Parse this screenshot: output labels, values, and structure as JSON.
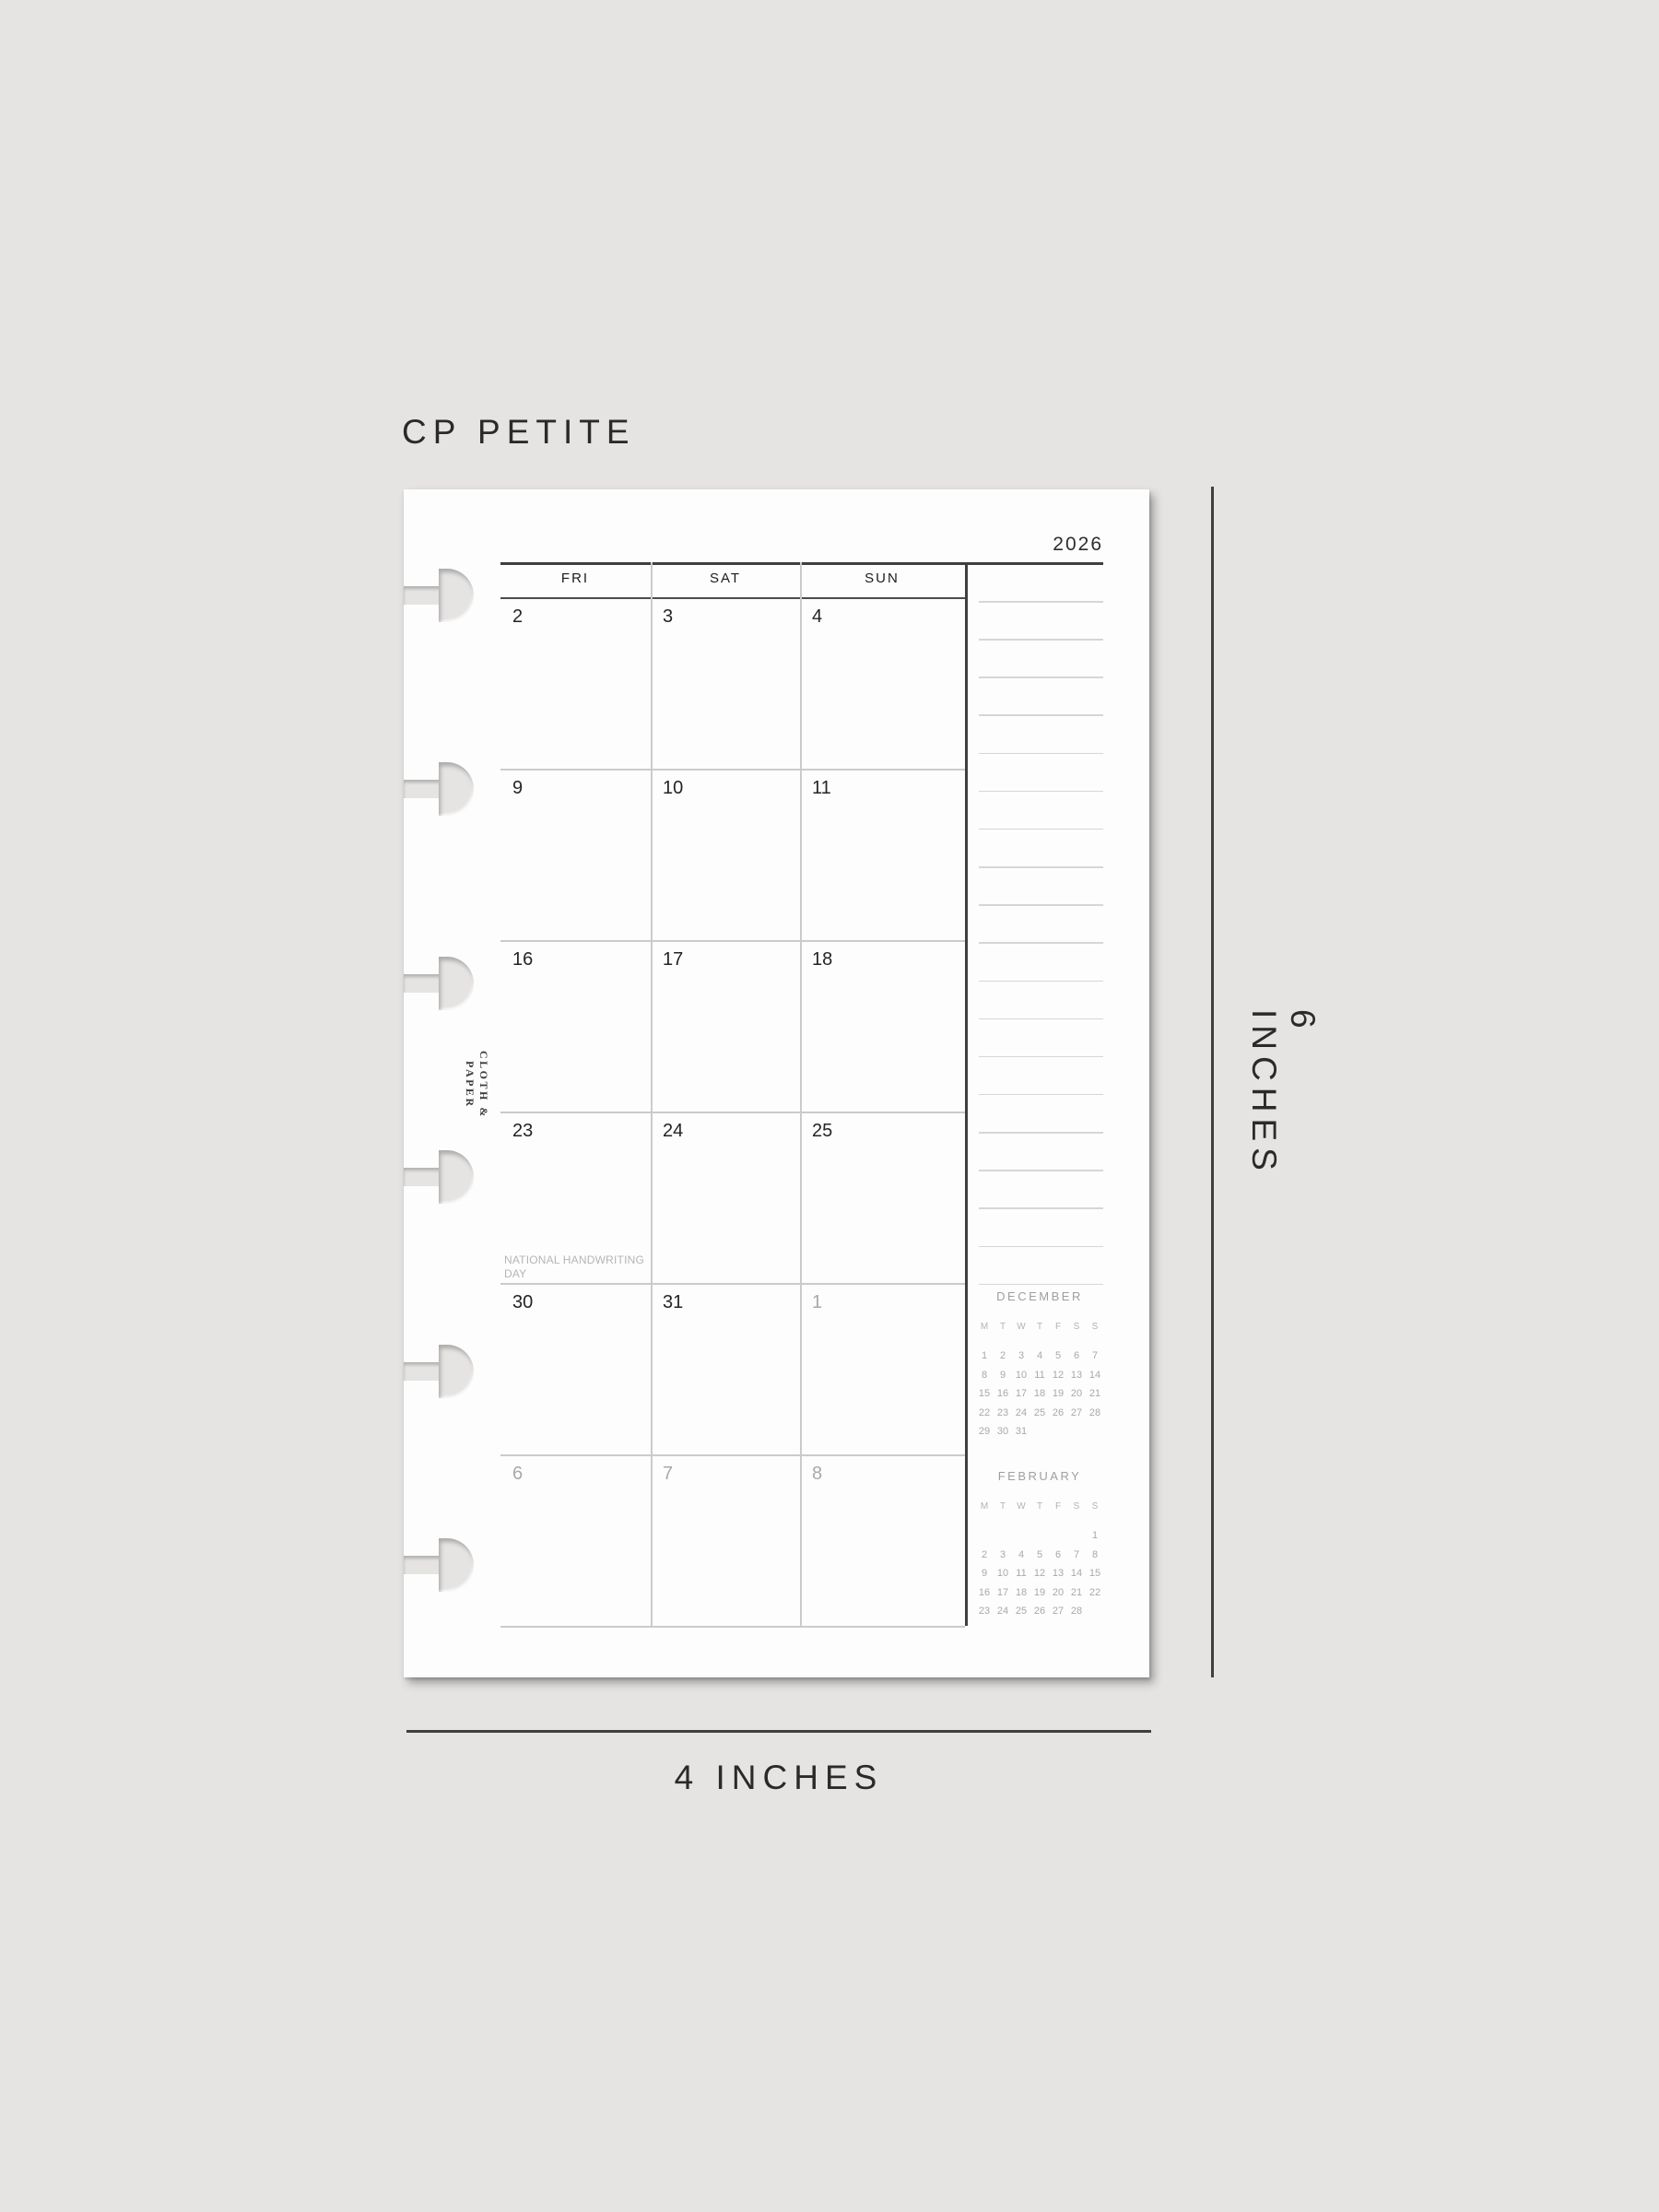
{
  "mockup": {
    "size_label": "CP PETITE",
    "width_label": "4 INCHES",
    "height_label": "6 INCHES"
  },
  "page": {
    "brand": "CLOTH & PAPER",
    "year": "2026",
    "day_headers": [
      "FRI",
      "SAT",
      "SUN"
    ],
    "weeks": [
      [
        {
          "d": "2"
        },
        {
          "d": "3"
        },
        {
          "d": "4"
        }
      ],
      [
        {
          "d": "9"
        },
        {
          "d": "10"
        },
        {
          "d": "11"
        }
      ],
      [
        {
          "d": "16"
        },
        {
          "d": "17"
        },
        {
          "d": "18"
        }
      ],
      [
        {
          "d": "23",
          "note": "NATIONAL HANDWRITING DAY"
        },
        {
          "d": "24"
        },
        {
          "d": "25"
        }
      ],
      [
        {
          "d": "30"
        },
        {
          "d": "31"
        },
        {
          "d": "1",
          "muted": true
        }
      ],
      [
        {
          "d": "6",
          "muted": true
        },
        {
          "d": "7",
          "muted": true
        },
        {
          "d": "8",
          "muted": true
        }
      ]
    ],
    "notes_line_count": 19,
    "disc_count": 6,
    "mini_calendars": [
      {
        "title": "DECEMBER",
        "day_headers": [
          "M",
          "T",
          "W",
          "T",
          "F",
          "S",
          "S"
        ],
        "weeks": [
          [
            "1",
            "2",
            "3",
            "4",
            "5",
            "6",
            "7"
          ],
          [
            "8",
            "9",
            "10",
            "11",
            "12",
            "13",
            "14"
          ],
          [
            "15",
            "16",
            "17",
            "18",
            "19",
            "20",
            "21"
          ],
          [
            "22",
            "23",
            "24",
            "25",
            "26",
            "27",
            "28"
          ],
          [
            "29",
            "30",
            "31",
            "",
            "",
            "",
            ""
          ]
        ]
      },
      {
        "title": "FEBRUARY",
        "day_headers": [
          "M",
          "T",
          "W",
          "T",
          "F",
          "S",
          "S"
        ],
        "weeks": [
          [
            "",
            "",
            "",
            "",
            "",
            "",
            "1"
          ],
          [
            "2",
            "3",
            "4",
            "5",
            "6",
            "7",
            "8"
          ],
          [
            "9",
            "10",
            "11",
            "12",
            "13",
            "14",
            "15"
          ],
          [
            "16",
            "17",
            "18",
            "19",
            "20",
            "21",
            "22"
          ],
          [
            "23",
            "24",
            "25",
            "26",
            "27",
            "28",
            ""
          ]
        ]
      }
    ]
  },
  "colors": {
    "background": "#e5e4e2",
    "paper": "#fdfdfd",
    "ink": "#2a2a2a",
    "muted_ink": "#a9a9a9",
    "line_dark": "#3f3f3f",
    "line_light": "#cbcbcb",
    "notes_line": "#d6d6d6"
  }
}
